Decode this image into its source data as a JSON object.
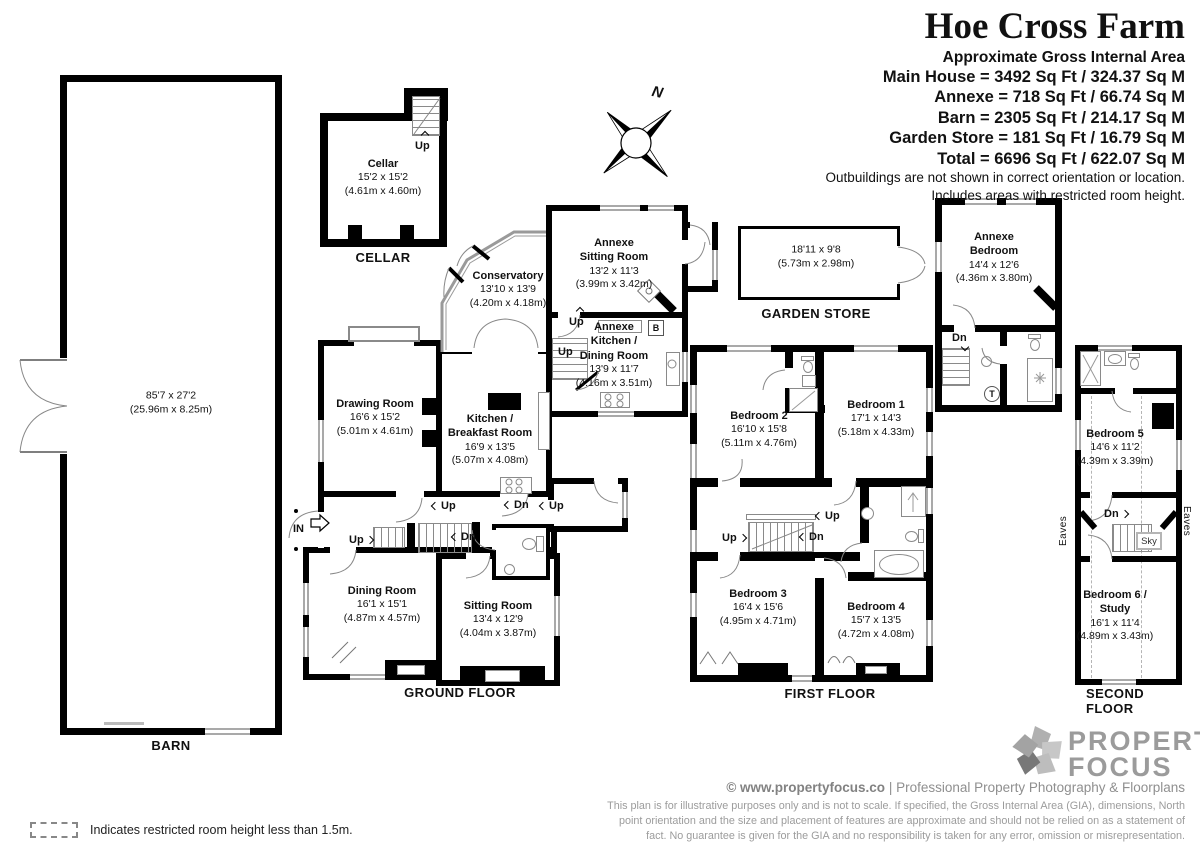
{
  "title_block": {
    "title": "Hoe Cross Farm",
    "subtitle": "Approximate Gross Internal Area",
    "areas": [
      "Main House = 3492 Sq Ft / 324.37 Sq M",
      "Annexe = 718 Sq Ft / 66.74 Sq M",
      "Barn = 2305 Sq Ft / 214.17 Sq M",
      "Garden Store = 181 Sq Ft / 16.79 Sq M",
      "Total = 6696 Sq Ft / 622.07 Sq M"
    ],
    "note1": "Outbuildings are not shown in correct orientation or location.",
    "note2": "Includes areas with restricted room height."
  },
  "compass": {
    "north_label": "N"
  },
  "floors": {
    "cellar": "CELLAR",
    "barn": "BARN",
    "ground": "GROUND FLOOR",
    "first": "FIRST FLOOR",
    "second": "SECOND FLOOR",
    "garden_store": "GARDEN STORE"
  },
  "rooms": {
    "barn": {
      "dims": "85'7 x 27'2",
      "metric": "(25.96m x 8.25m)"
    },
    "cellar": {
      "name": "Cellar",
      "dims": "15'2 x 15'2",
      "metric": "(4.61m x 4.60m)"
    },
    "conservatory": {
      "name": "Conservatory",
      "dims": "13'10 x 13'9",
      "metric": "(4.20m x 4.18m)"
    },
    "drawing_room": {
      "name": "Drawing Room",
      "dims": "16'6 x 15'2",
      "metric": "(5.01m x 4.61m)"
    },
    "kitchen": {
      "name": "Kitchen /\nBreakfast Room",
      "dims": "16'9 x 13'5",
      "metric": "(5.07m x 4.08m)"
    },
    "annexe_sitting": {
      "name": "Annexe\nSitting Room",
      "dims": "13'2 x 11'3",
      "metric": "(3.99m x 3.42m)"
    },
    "annexe_kitchen": {
      "name": "Annexe\nKitchen /\nDining Room",
      "dims": "13'9 x 11'7",
      "metric": "(4.16m x 3.51m)"
    },
    "dining_room": {
      "name": "Dining Room",
      "dims": "16'1 x 15'1",
      "metric": "(4.87m x 4.57m)"
    },
    "sitting_room": {
      "name": "Sitting Room",
      "dims": "13'4 x 12'9",
      "metric": "(4.04m x 3.87m)"
    },
    "garden_store": {
      "dims": "18'11 x 9'8",
      "metric": "(5.73m x 2.98m)"
    },
    "annexe_bedroom": {
      "name": "Annexe\nBedroom",
      "dims": "14'4 x 12'6",
      "metric": "(4.36m x 3.80m)"
    },
    "bedroom1": {
      "name": "Bedroom 1",
      "dims": "17'1 x 14'3",
      "metric": "(5.18m x 4.33m)"
    },
    "bedroom2": {
      "name": "Bedroom 2",
      "dims": "16'10 x 15'8",
      "metric": "(5.11m x 4.76m)"
    },
    "bedroom3": {
      "name": "Bedroom 3",
      "dims": "16'4 x 15'6",
      "metric": "(4.95m x 4.71m)"
    },
    "bedroom4": {
      "name": "Bedroom 4",
      "dims": "15'7 x 13'5",
      "metric": "(4.72m x 4.08m)"
    },
    "bedroom5": {
      "name": "Bedroom 5",
      "dims": "14'6 x 11'2",
      "metric": "(4.39m x 3.39m)"
    },
    "bedroom6": {
      "name": "Bedroom 6 /\nStudy",
      "dims": "16'1 x 11'4",
      "metric": "(4.89m x 3.43m)"
    }
  },
  "nav": {
    "up": "Up",
    "dn": "Dn",
    "in": "IN"
  },
  "misc": {
    "boiler": "B",
    "tank": "T",
    "sky": "Sky",
    "eaves": "Eaves"
  },
  "legend": {
    "text": "Indicates restricted room height less than 1.5m."
  },
  "footer": {
    "brand_top": "PROPERTY",
    "brand_bottom": "FOCUS",
    "credit_bold": "© www.propertyfocus.co",
    "credit_sep": "|",
    "credit_rest": "Professional Property Photography & Floorplans",
    "disclaimer_lines": [
      "This plan is for illustrative purposes only and is not to scale. If specified, the Gross Internal Area (GIA), dimensions, North",
      "point orientation and the size and placement of features are approximate and should not be relied on as a statement of",
      "fact. No guarantee is given for the GIA and no responsibility is taken for any error, omission or misrepresentation."
    ],
    "colors": {
      "brand_gray": "#9b9b9b",
      "wall_black": "#000000"
    }
  }
}
